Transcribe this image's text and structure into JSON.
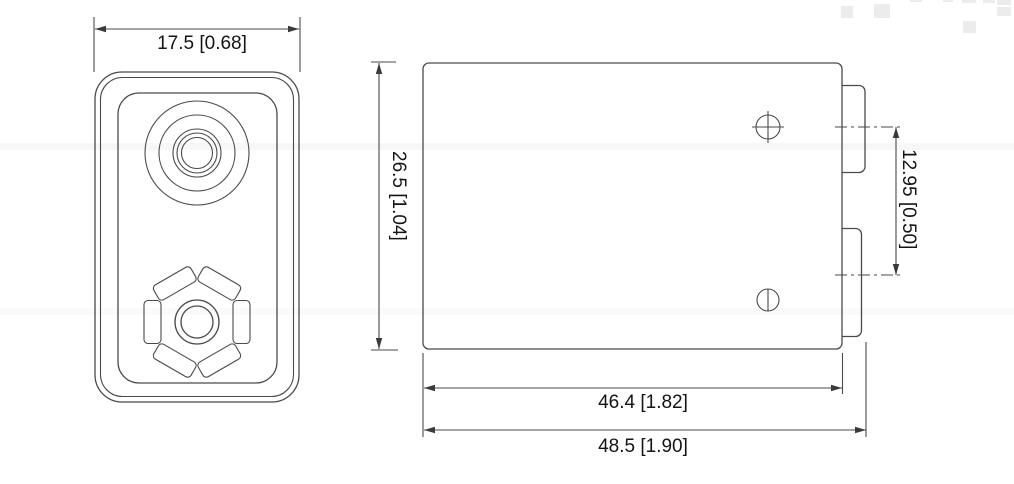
{
  "drawing": {
    "views": {
      "top_view": {
        "width_dim": "17.5 [0.68]"
      },
      "side_view": {
        "height_dim": "26.5 [1.04]",
        "terminal_spacing_dim": "12.95 [0.50]",
        "body_width_dim": "46.4 [1.82]",
        "overall_width_dim": "48.5 [1.90]",
        "positive_terminal_symbol": "circle-plus",
        "negative_terminal_symbol": "circle-minus"
      }
    },
    "colors": {
      "line": "#4a4a4a",
      "text": "#141414",
      "background": "#ffffff",
      "watermark": "#ececec"
    }
  }
}
